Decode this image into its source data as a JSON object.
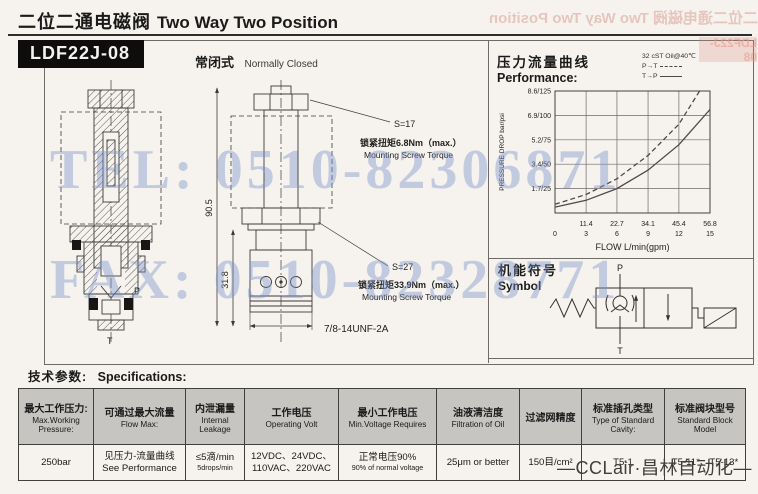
{
  "page": {
    "title_zh": "二位二通电磁阀",
    "title_en": "Two Way Two Position",
    "model": "LDF22J-08",
    "variant_zh": "常闭式",
    "variant_en": "Normally Closed",
    "footer_brand": "—CCLair·昌林自动化—",
    "watermark_tel": "TEL: 0510-82306871",
    "watermark_fax": "FAX: 0510-82328771",
    "ghost_title": "二位二通电磁阀 Two Way Two Position",
    "ghost_model": "LDF22J-08"
  },
  "drawing": {
    "s17": "S=17",
    "torque1_zh": "锁紧扭矩6.8Nm（max.）",
    "torque1_en": "Mounting Screw Torque",
    "s27": "S=27",
    "torque2_zh": "锁紧扭矩33.9Nm（max.）",
    "torque2_en": "Mounting Screw Torque",
    "thread": "7/8-14UNF-2A",
    "dim_total": "90.5",
    "dim_lower": "31.8",
    "port_p": "P",
    "port_t": "T"
  },
  "performance": {
    "heading_zh": "压力流量曲线",
    "heading_en": "Performance:",
    "note": "32 cST Oil@40℃",
    "legend": [
      {
        "label": "P→T",
        "style": "dashed"
      },
      {
        "label": "T→P",
        "style": "solid"
      }
    ]
  },
  "chart_data": {
    "type": "line",
    "title": "压力流量曲线 Performance",
    "xlabel": "FLOW L/min(gpm)",
    "ylabel": "PRESSURE DROP bar/psi",
    "xlim": [
      0,
      56.8
    ],
    "ylim_psi": [
      0,
      125
    ],
    "grid": true,
    "x_tick_values": [
      11.4,
      22.7,
      34.1,
      45.4,
      56.8
    ],
    "x_ticks_lmin": [
      "11.4",
      "22.7",
      "34.1",
      "45.4",
      "56.8"
    ],
    "x_origin_label": "0",
    "x_ticks_gpm": [
      "3",
      "6",
      "9",
      "12",
      "15"
    ],
    "y_tick_values_psi": [
      125,
      100,
      75,
      50,
      25
    ],
    "y_ticks": [
      "8.6/125",
      "6.9/100",
      "5.2/75",
      "3.4/50",
      "1.7/25"
    ],
    "note": "32 cST Oil@40℃",
    "legend_position": "top-right",
    "series": [
      {
        "name": "P→T",
        "style": "dashed",
        "x": [
          0,
          11.4,
          22.7,
          34.1,
          45.4,
          53
        ],
        "y_psi": [
          9,
          19,
          35,
          59,
          91,
          125
        ],
        "y_bar": [
          0.6,
          1.3,
          2.4,
          4.1,
          6.3,
          8.6
        ]
      },
      {
        "name": "T→P",
        "style": "solid",
        "x": [
          0,
          11.4,
          22.7,
          34.1,
          45.4,
          56.8
        ],
        "y_psi": [
          6,
          13,
          25,
          44,
          70,
          106
        ],
        "y_bar": [
          0.4,
          0.9,
          1.7,
          3.0,
          4.8,
          7.3
        ]
      }
    ]
  },
  "symbol": {
    "heading_zh": "机能符号",
    "heading_en": "Symbol",
    "port_top": "P",
    "port_bottom": "T"
  },
  "specs": {
    "heading_zh": "技术参数:",
    "heading_en": "Specifications:",
    "columns": [
      {
        "zh": "最大工作压力:",
        "en": "Max.Working Pressure:"
      },
      {
        "zh": "可通过最大流量",
        "en": "Flow Max:"
      },
      {
        "zh": "内泄漏量",
        "en": "Internal Leakage"
      },
      {
        "zh": "工作电压",
        "en": "Operating Volt"
      },
      {
        "zh": "最小工作电压",
        "en": "Min.Voltage Requires"
      },
      {
        "zh": "油液清洁度",
        "en": "Filtration of Oil"
      },
      {
        "zh": "过滤网精度",
        "en": ""
      },
      {
        "zh": "标准插孔类型",
        "en": "Type of Standard Cavity:"
      },
      {
        "zh": "标准阀块型号",
        "en": "Standard Block Model"
      }
    ],
    "values": [
      {
        "lines": [
          {
            "t": "250bar"
          }
        ]
      },
      {
        "lines": [
          {
            "t": "见压力-流量曲线"
          },
          {
            "t": "See Performance"
          }
        ]
      },
      {
        "lines": [
          {
            "t": "≤5滴/min"
          },
          {
            "t": "5drops/min",
            "small": true
          }
        ]
      },
      {
        "lines": [
          {
            "t": "12VDC、24VDC、"
          },
          {
            "t": "110VAC、220VAC"
          }
        ]
      },
      {
        "lines": [
          {
            "t": "正常电压90%"
          },
          {
            "t": "90% of normal voltage",
            "small": true
          }
        ]
      },
      {
        "lines": [
          {
            "t": "25μm or better"
          }
        ]
      },
      {
        "lines": [
          {
            "t": "150目/cm²"
          }
        ]
      },
      {
        "lines": [
          {
            "t": "T5-1"
          }
        ]
      },
      {
        "lines": [
          {
            "t": "T5-11*、T5-13*"
          }
        ]
      }
    ]
  }
}
